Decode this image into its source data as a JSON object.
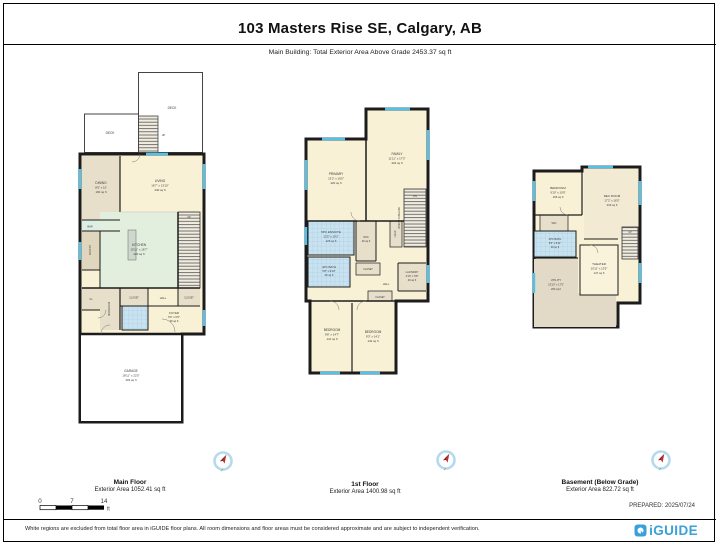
{
  "header": {
    "title": "103 Masters Rise SE, Calgary, AB",
    "subtitle": "Main Building: Total Exterior Area Above Grade 2453.37 sq ft"
  },
  "floors": [
    {
      "caption": "Main Floor",
      "area_label": "Exterior Area 1052.41 sq ft",
      "rooms": {
        "deck_top": {
          "name": "DECK"
        },
        "deck_left": {
          "name": "DECK"
        },
        "deck_stairs": {
          "name": "UP"
        },
        "dining": {
          "name": "DINING",
          "dims": "8'6\" x 10'",
          "area": "100 sq ft"
        },
        "living": {
          "name": "LIVING",
          "dims": "16'7\" x 13'10\"",
          "area": "240 sq ft"
        },
        "bar": {
          "name": "BAR"
        },
        "pantry": {
          "name": "PANTRY"
        },
        "kitchen": {
          "name": "KITCHEN",
          "dims": "15'11\" x 16'7\"",
          "area": "220 sq ft"
        },
        "stairs": {
          "name": "UP"
        },
        "hall": {
          "name": "HALL"
        },
        "closet_a": {
          "name": "CLOSET"
        },
        "closet_b": {
          "name": "CLOSET"
        },
        "cl": {
          "name": "CL"
        },
        "mudroom": {
          "name": "MUDROOM"
        },
        "foyer": {
          "name": "FOYER",
          "dims": "6'6\" x 6'9\"",
          "area": "36 sq ft"
        },
        "garage": {
          "name": "GARAGE",
          "dims": "18'11\" x 22'5\"",
          "area": "402 sq ft"
        }
      }
    },
    {
      "caption": "1st Floor",
      "area_label": "Exterior Area 1400.98 sq ft",
      "rooms": {
        "primary": {
          "name": "PRIMARY",
          "dims": "13'2\" x 16'5\"",
          "area": "220 sq ft"
        },
        "family": {
          "name": "FAMILY",
          "dims": "11'11\" x 17'3\"",
          "area": "202 sq ft"
        },
        "open_below": {
          "name": "OPEN TO BELOW"
        },
        "stairs": {
          "name": "DN"
        },
        "ensuite": {
          "name": "5PC ENSUITE",
          "dims": "12'5\" x 10'2\"",
          "area": "126 sq ft"
        },
        "wic": {
          "name": "WIC",
          "area": "49 sq ft"
        },
        "linen": {
          "name": "LINEN"
        },
        "bath": {
          "name": "4PC BATH",
          "dims": "5'8\" x 9'10\"",
          "area": "46 sq ft"
        },
        "closet_a": {
          "name": "CLOSET"
        },
        "closet_b": {
          "name": "CLOSET"
        },
        "hall": {
          "name": "HALL"
        },
        "laundry": {
          "name": "LAUNDRY",
          "dims": "4'10\" x 5'8\"",
          "area": "40 sq ft"
        },
        "bedroom_a": {
          "name": "BEDROOM",
          "dims": "9'8\" x 14'7\"",
          "area": "141 sq ft"
        },
        "bedroom_b": {
          "name": "BEDROOM",
          "dims": "9'3\" x 14'1\"",
          "area": "142 sq ft"
        }
      }
    },
    {
      "caption": "Basement (Below Grade)",
      "area_label": "Exterior Area 822.72 sq ft",
      "rooms": {
        "bedroom": {
          "name": "BEDROOM",
          "dims": "9'10\" x 10'9\"",
          "area": "106 sq ft"
        },
        "rec": {
          "name": "REC ROOM",
          "dims": "17'2\" x 16'5\"",
          "area": "233 sq ft"
        },
        "wic": {
          "name": "WIC"
        },
        "bath": {
          "name": "4PC BATH",
          "dims": "5'6\" x 8'11\"",
          "area": "49 sq ft"
        },
        "theater": {
          "name": "THEATER",
          "dims": "10'11\" x 13'5\"",
          "area": "147 sq ft"
        },
        "utility": {
          "name": "UTILITY",
          "dims": "23'10\" x 17'5\"",
          "area": "263 sq ft"
        },
        "stairs": {
          "name": "UP"
        }
      }
    }
  ],
  "scale_bar": {
    "t0": "0",
    "t1": "7",
    "t2": "14",
    "unit": "ft"
  },
  "footer": {
    "disclaimer": "White regions are excluded from total floor area in iGUIDE floor plans. All room dimensions and floor areas must be considered approximate and are subject to independent verification.",
    "prepared": "PREPARED: 2025/07/24",
    "brand": "iGUIDE"
  },
  "colors": {
    "wall": "#1c1c1c",
    "cream": "#f8f1d5",
    "tan": "#e8dfca",
    "mint": "#e2eede",
    "bath_blue": "#c8e2f0",
    "window": "#54c2e8",
    "brand_blue": "#3aa0d8"
  }
}
